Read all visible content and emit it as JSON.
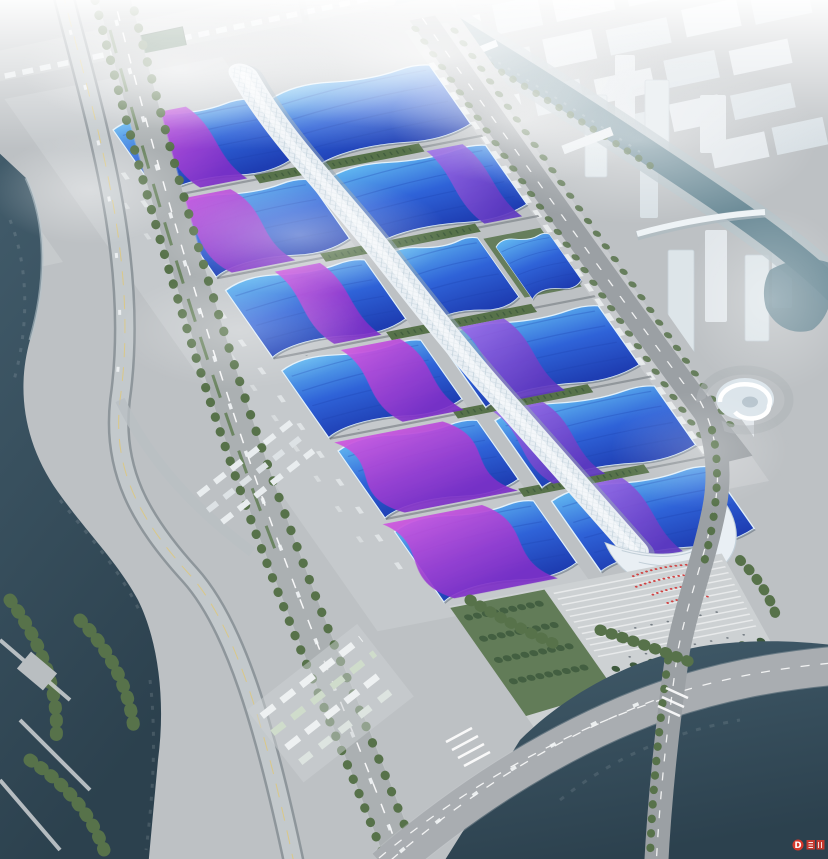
{
  "meta": {
    "description": "Aerial architectural rendering of a large exhibition center: paired halls with wavy blue roofs crossed by purple ribbon stripes flank a white serpentine central corridor that ends in a white shell entrance and stepped plaza; the site is bordered by tree-lined boulevards, parking lots, dark canals with bridges, a spiral white pavilion, and a hazy white city skyline fading into fog."
  },
  "watermark": {
    "symbol": "D"
  },
  "palette": {
    "haze-top": "#f1f5f7",
    "city-a": "#e5eaee",
    "city-b": "#d9e1e6",
    "city-line": "#c9d3da",
    "tower": "#dfe7ec",
    "canal": "#6e8d99",
    "canal-bank": "#b6c3c9",
    "river": "#425c6b",
    "river-deep": "#2c414e",
    "water-hi": "#6b8596",
    "ground": "#bdc1c4",
    "ground-light": "#cdd1d3",
    "road": "#9ba0a4",
    "road-edge": "#c9cdcf",
    "lane": "#ffffff",
    "roof-cyan": "#64bcf2",
    "roof-mid": "#2f63d8",
    "roof-deep": "#1e3db2",
    "roof-trim": "#e2f1fb",
    "ridge": "#1d3fae",
    "rib-a": "#cf55e0",
    "rib-b": "#7c2fc8",
    "rib2-a": "#9b6ae8",
    "rib2-b": "#5f37c0",
    "spine": "#e9eff4",
    "spine-shadow": "#93a7b6",
    "quilt": "#c3d2dc",
    "green": "#57724a",
    "green-dark": "#3e5a3d",
    "shed": "#3c6146",
    "plaza": "#cdd1d3",
    "step": "#e8eaeb",
    "crowd": "#d04343",
    "wm": "#d6382c",
    "car": "#f2f5f6",
    "dock": "#878d92"
  }
}
